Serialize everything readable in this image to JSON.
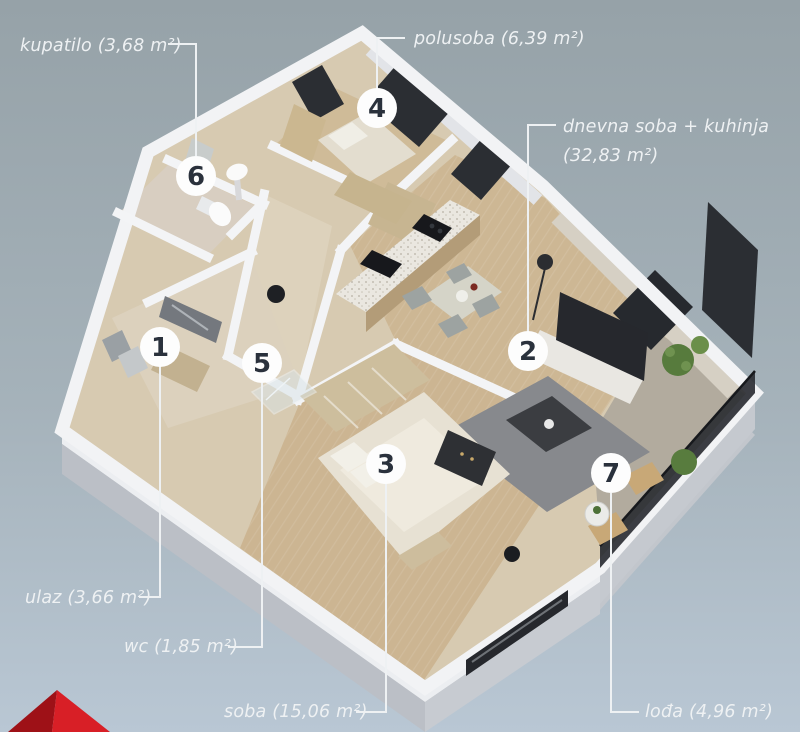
{
  "background": {
    "top_color": "#96a2a8",
    "bottom_color": "#b9c7d4"
  },
  "labels": {
    "kupatilo": "kupatilo (3,68 m²)",
    "polusoba": "polusoba (6,39 m²)",
    "dnevna_line1": "dnevna soba + kuhinja",
    "dnevna_line2": "(32,83 m²)",
    "ulaz": "ulaz (3,66 m²)",
    "wc": "wc (1,85 m²)",
    "soba": "soba (15,06 m²)",
    "lodja": "lođa (4,96 m²)"
  },
  "markers": {
    "m1": "1",
    "m2": "2",
    "m3": "3",
    "m4": "4",
    "m5": "5",
    "m6": "6",
    "m7": "7"
  },
  "rooms": [
    {
      "marker": "1",
      "name": "ulaz",
      "area_m2": "3,66"
    },
    {
      "marker": "2",
      "name": "dnevna soba + kuhinja",
      "area_m2": "32,83"
    },
    {
      "marker": "3",
      "name": "soba",
      "area_m2": "15,06"
    },
    {
      "marker": "4",
      "name": "polusoba",
      "area_m2": "6,39"
    },
    {
      "marker": "5",
      "name": "wc",
      "area_m2": "1,85"
    },
    {
      "marker": "6",
      "name": "kupatilo",
      "area_m2": "3,68"
    },
    {
      "marker": "7",
      "name": "lođa",
      "area_m2": "4,96"
    }
  ],
  "colors": {
    "label_text": "#eef1f3",
    "leader_line": "#eef1f3",
    "marker_fill": "#fdfdfd",
    "marker_text": "#2a313c",
    "logo_red": "#d81f26",
    "logo_red_dark": "#9e1117",
    "wall_white": "#f2f3f5",
    "wood_floor": "#cdb794"
  }
}
